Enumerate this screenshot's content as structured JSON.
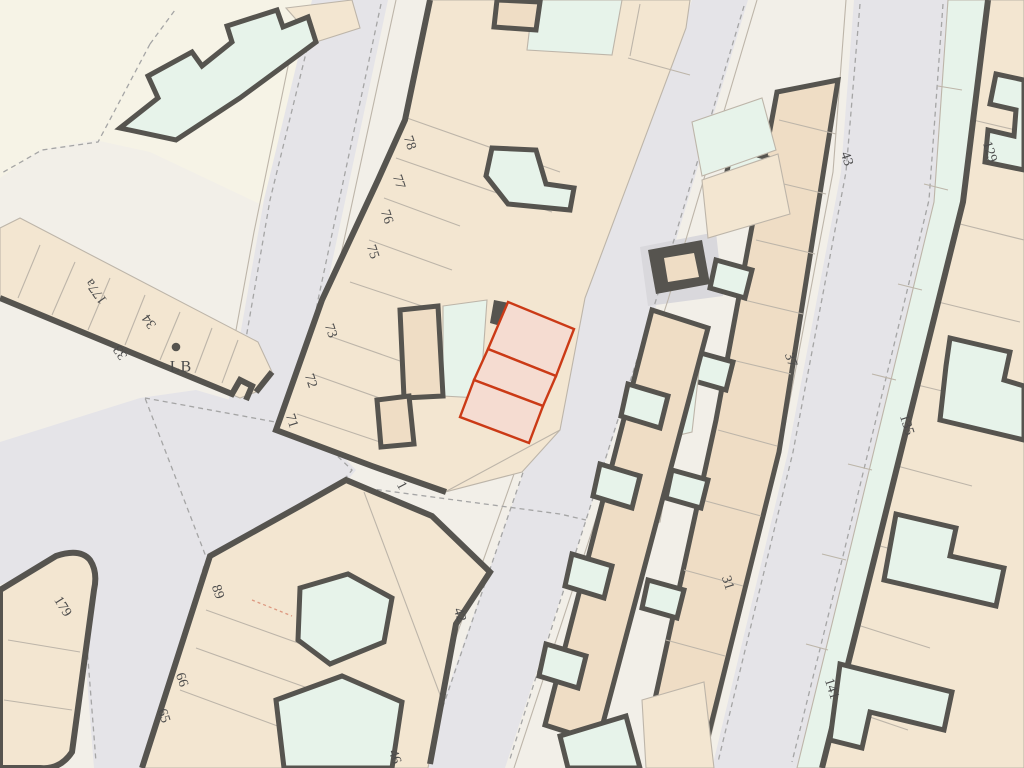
{
  "map": {
    "kind": "cadastral-street-map",
    "highlight": {
      "description": "selected parcel group of 3 sections",
      "stroke": "#cb3a16",
      "fill": "#f5dcd1",
      "sections": 3
    },
    "labels": [
      {
        "text": "78",
        "x": 409,
        "y": 143,
        "rot": 72
      },
      {
        "text": "77",
        "x": 398,
        "y": 182,
        "rot": 72
      },
      {
        "text": "76",
        "x": 386,
        "y": 217,
        "rot": 72
      },
      {
        "text": "75",
        "x": 372,
        "y": 252,
        "rot": 72
      },
      {
        "text": "73",
        "x": 330,
        "y": 331,
        "rot": 72
      },
      {
        "text": "72",
        "x": 310,
        "y": 381,
        "rot": 72
      },
      {
        "text": "71",
        "x": 291,
        "y": 421,
        "rot": 72
      },
      {
        "text": "1",
        "x": 401,
        "y": 486,
        "rot": 62
      },
      {
        "text": "177a",
        "x": 97,
        "y": 291,
        "rot": -125
      },
      {
        "text": "34",
        "x": 150,
        "y": 321,
        "rot": -125
      },
      {
        "text": "33",
        "x": 121,
        "y": 352,
        "rot": -125
      },
      {
        "text": "LB",
        "x": 181,
        "y": 368,
        "rot": 0,
        "size": "large"
      },
      {
        "text": "179",
        "x": 62,
        "y": 607,
        "rot": 58
      },
      {
        "text": "89",
        "x": 217,
        "y": 592,
        "rot": 72
      },
      {
        "text": "66",
        "x": 181,
        "y": 680,
        "rot": 72
      },
      {
        "text": "65",
        "x": 163,
        "y": 716,
        "rot": 72
      },
      {
        "text": "46",
        "x": 394,
        "y": 757,
        "rot": 72
      },
      {
        "text": "42",
        "x": 459,
        "y": 615,
        "rot": 72
      },
      {
        "text": "31",
        "x": 727,
        "y": 583,
        "rot": 72
      },
      {
        "text": "37",
        "x": 790,
        "y": 360,
        "rot": 72
      },
      {
        "text": "43",
        "x": 846,
        "y": 159,
        "rot": 72
      },
      {
        "text": "129",
        "x": 989,
        "y": 152,
        "rot": 72
      },
      {
        "text": "135",
        "x": 906,
        "y": 425,
        "rot": 72
      },
      {
        "text": "141",
        "x": 831,
        "y": 689,
        "rot": 72
      }
    ],
    "point_features": [
      {
        "name": "letter-box-dot",
        "x": 176,
        "y": 347,
        "r": 4.3
      }
    ]
  },
  "palette": {
    "bg": "#f2efe8",
    "open": "#f6f3e6",
    "road": "#e5e4e8",
    "road2": "#d9d8dc",
    "parcel": "#f3e6d1",
    "bld": "#efddc5",
    "mint": "#e7f3ea",
    "dark": "#56544f",
    "thin": "#bdb5a9",
    "dash": "#a5a5a5",
    "hl": "#cb3a16",
    "hlfill": "#f5dcd1",
    "label": "#4b4b4b",
    "reddash": "#dd9880"
  }
}
